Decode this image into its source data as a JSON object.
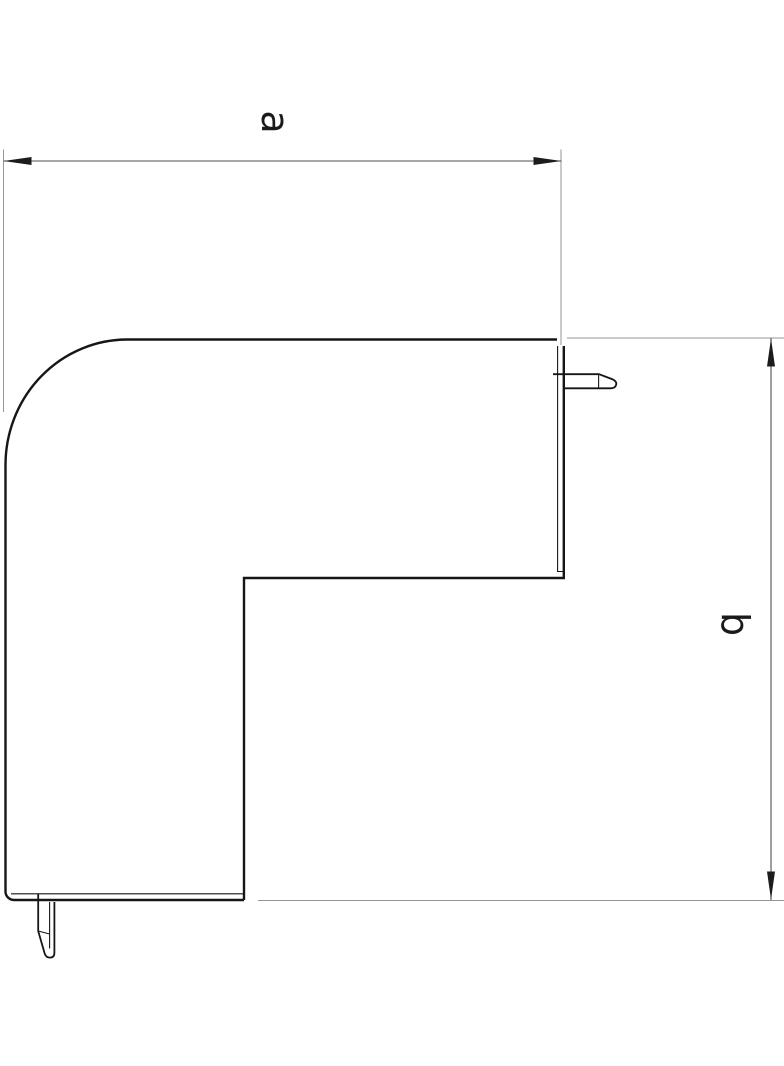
{
  "drawing": {
    "type": "technical-dimension-drawing",
    "subject": "flat-external-corner-piece",
    "dimensions": {
      "width_label": "a",
      "height_label": "b"
    },
    "colors": {
      "background": "#ffffff",
      "outline": "#161616",
      "dimension_line": "#4f4f4f",
      "extension_line": "#969696",
      "arrow": "#1c1c1c",
      "label": "#1a1a1a"
    }
  }
}
